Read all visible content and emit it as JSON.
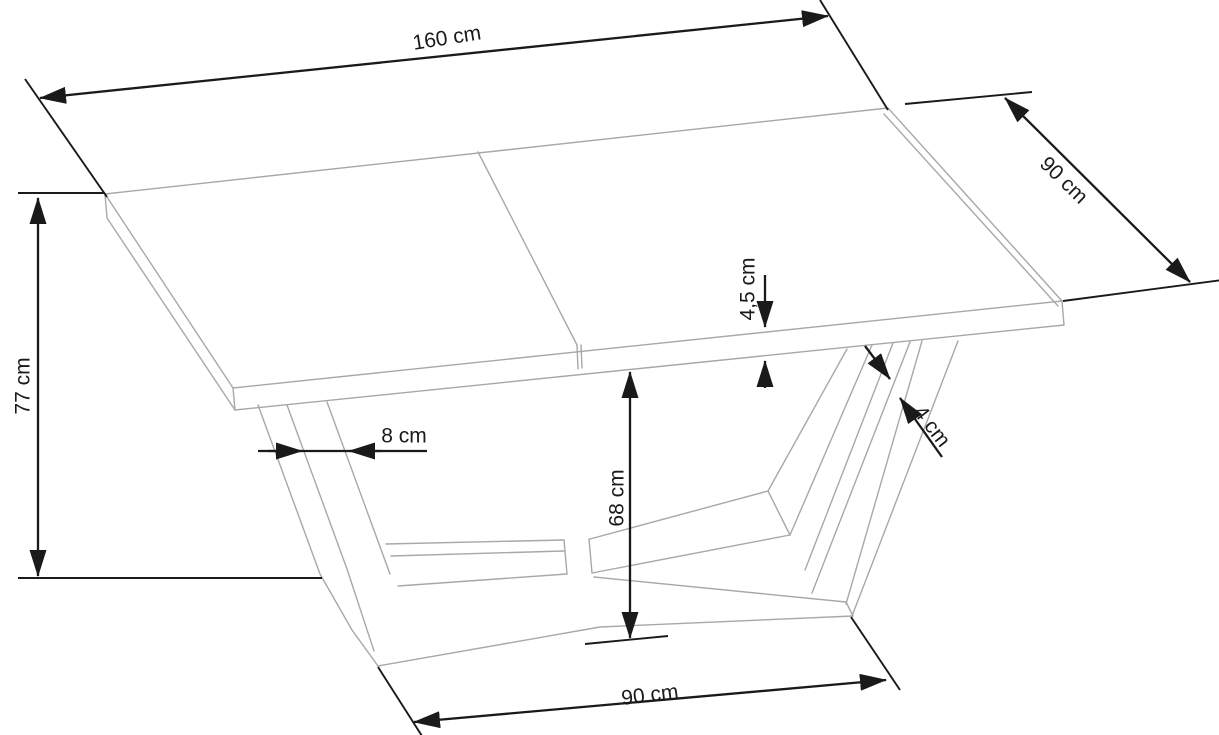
{
  "diagram": {
    "type": "furniture-dimension-drawing",
    "subject": "rectangular dining table with V-shaped pedestal base",
    "unit": "cm",
    "labels": {
      "length_top": "160 cm",
      "depth_right": "90 cm",
      "height_left": "77 cm",
      "top_thickness": "4,5 cm",
      "leg_offset": "8 cm",
      "leg_bar_thickness": "4 cm",
      "underside_clearance": "68 cm",
      "base_width_bottom": "90 cm"
    },
    "dimensions_cm": {
      "length": 160,
      "depth": 90,
      "height": 77,
      "top_thickness": 4.5,
      "leg_offset": 8,
      "leg_bar_thickness": 4,
      "underside_clearance": 68,
      "base_width": 90
    },
    "colors": {
      "background": "#ffffff",
      "dimension_lines": "#1a1a1a",
      "drawing_lines": "#a8a8a8"
    }
  }
}
